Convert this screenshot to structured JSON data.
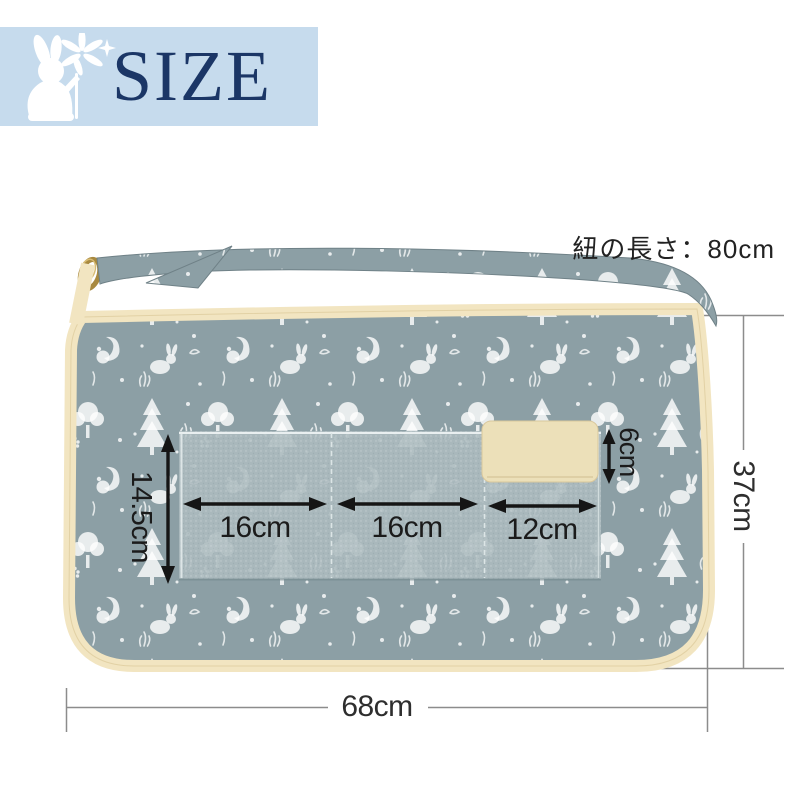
{
  "banner": {
    "title": "SIZE"
  },
  "icons": {
    "banner_icon": "rabbit-holding-flower-icon"
  },
  "annotations": {
    "strap_length": "紐の長さ：80cm",
    "body_height": "37cm",
    "body_width": "68cm",
    "pocket_height": "14.5cm",
    "pocket_left_width": "16cm",
    "pocket_middle_width": "16cm",
    "pocket_right_width": "12cm",
    "loop_height": "6cm"
  },
  "colors": {
    "banner_bg": "#c6dbed",
    "banner_text": "#1b3666",
    "fabric": "#8c9fa5",
    "fabric_print": "#ffffff",
    "chambray": "#a9b8bc",
    "cream": "#f2e5c1",
    "patch": "#ece0b9",
    "ring": "#a8893f",
    "dimline": "#8c8c8c",
    "arrow": "#151515",
    "text": "#1b1b1b"
  }
}
